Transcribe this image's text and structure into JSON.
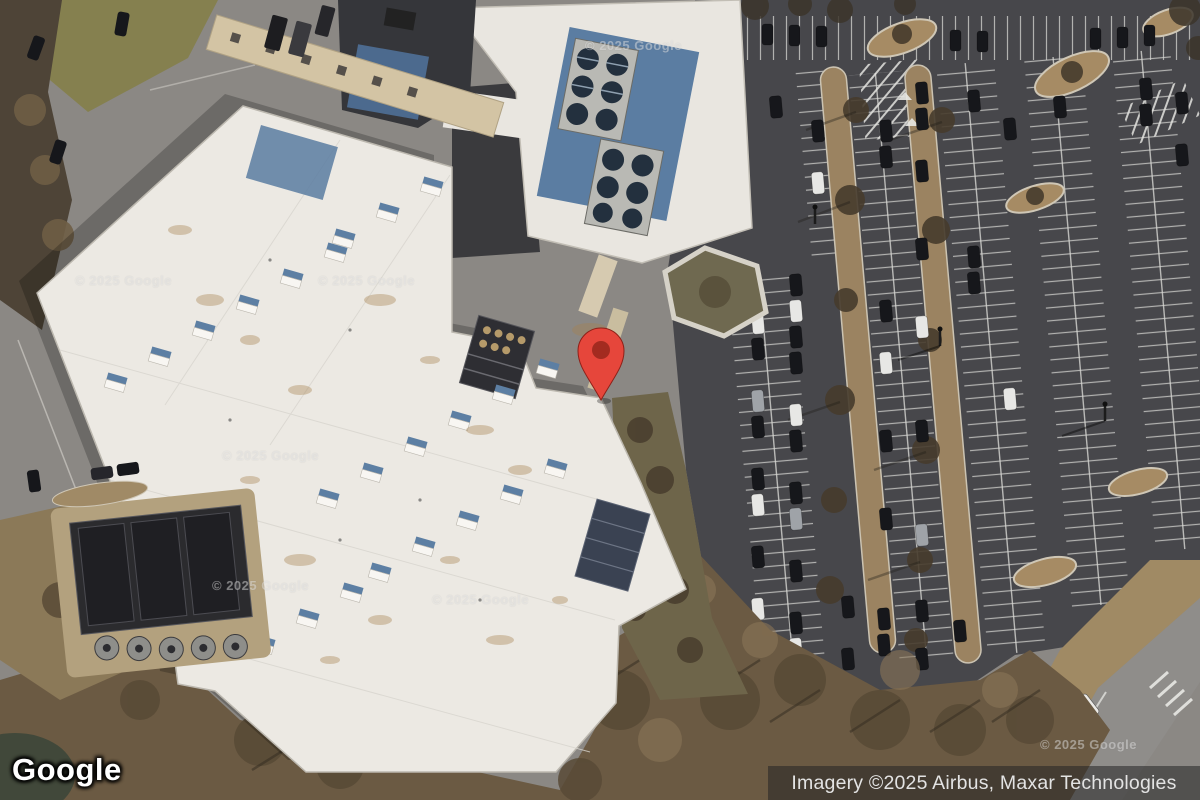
{
  "branding": {
    "logo_text": "Google"
  },
  "attribution": {
    "text": "Imagery ©2025 Airbus, Maxar Technologies"
  },
  "watermarks": {
    "text": "© 2025 Google"
  },
  "marker": {
    "label": "dropped-pin"
  },
  "palette": {
    "marker_red": "#E6463B",
    "marker_dot": "#A32B20",
    "roof_white": "#ECE9E3",
    "asphalt": "#47474B",
    "island_tan": "#9B8361",
    "trees_brown": "#6B5A43",
    "glass_blue": "#5B7DA2",
    "attribution_bg": "rgba(36,36,36,0.55)",
    "watermark_color": "rgba(255,255,255,0.38)"
  },
  "scene": {
    "type": "satellite-imagery",
    "features": [
      "large white-roof office building with skylights and rooftop HVAC",
      "upper building with blue glass roof section and fan units",
      "dark asphalt parking lots with white stalls, parked cars and tan tree islands",
      "bare winter trees along bottom and left",
      "access road with crosswalk at bottom right",
      "red map pin marker near building rear entrance"
    ]
  }
}
